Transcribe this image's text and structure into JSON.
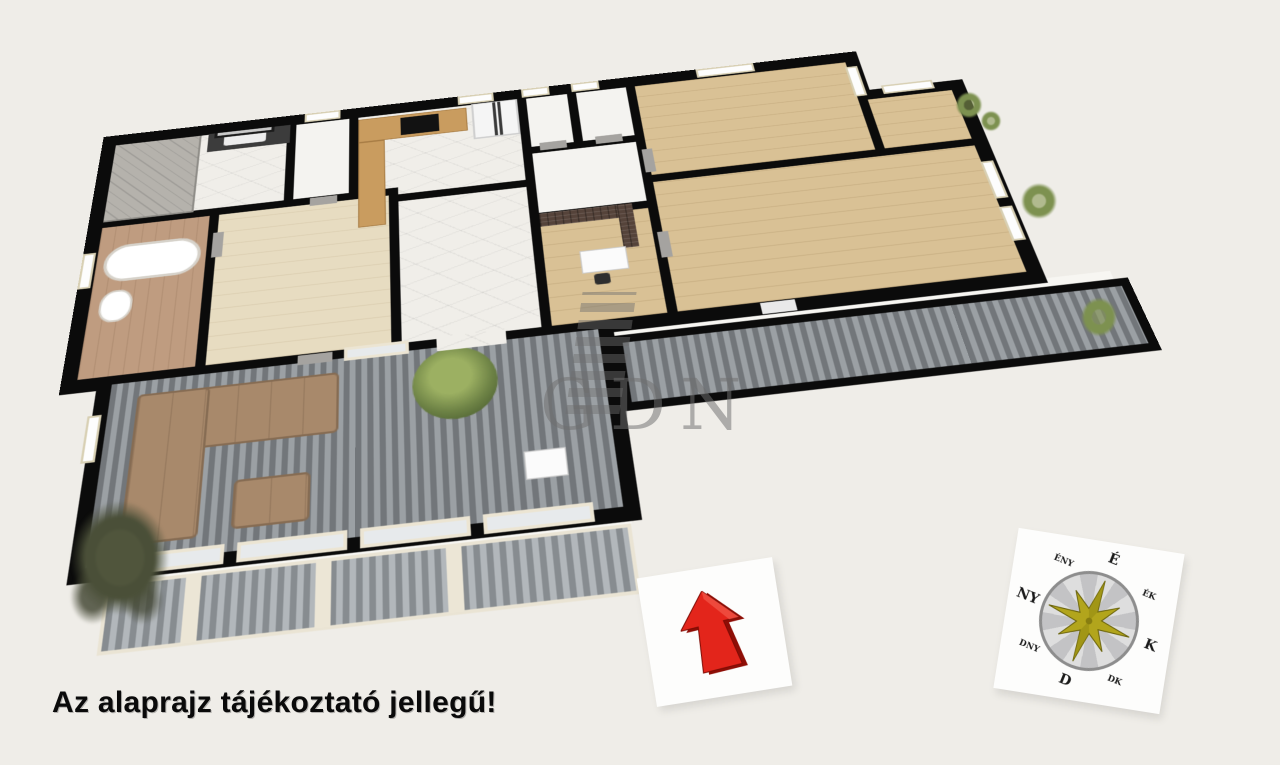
{
  "image": {
    "background": "#efede8"
  },
  "caption": {
    "text": "Az alaprajz tájékoztató jellegű!"
  },
  "watermark": {
    "text": "GDN"
  },
  "compass": {
    "labels": {
      "n": "É",
      "ne": "ÉK",
      "e": "K",
      "se": "DK",
      "s": "D",
      "sw": "DNY",
      "w": "NY",
      "nw": "ÉNY"
    }
  },
  "colors": {
    "bg": "#efede8",
    "wall": "#0b0b0b",
    "marble": "#f0eee9",
    "plain": "#f4f3f0",
    "wood": "#d9c195",
    "wood_pale": "#e7dcc1",
    "tan": "#bf9c80",
    "deck_a": "#72767a",
    "deck_b": "#9ba0a4",
    "pdeck_a": "#878c90",
    "pdeck_b": "#b2b7bb",
    "sofa": "#a8896b",
    "sofa_edge": "#866c53",
    "brick": "#55433a",
    "counter": "#c99c5f",
    "arrow": "#e3251b",
    "arrow_dark": "#8e0e06",
    "arrow_light": "#f25548",
    "gold": "#b2a51c",
    "gold_dark": "#6b640c",
    "bush": "#7d9150",
    "tree": "#4a4f38",
    "card": "#fdfdfc",
    "ink": "#0a0a0a",
    "wm": "#6f6f6f"
  }
}
